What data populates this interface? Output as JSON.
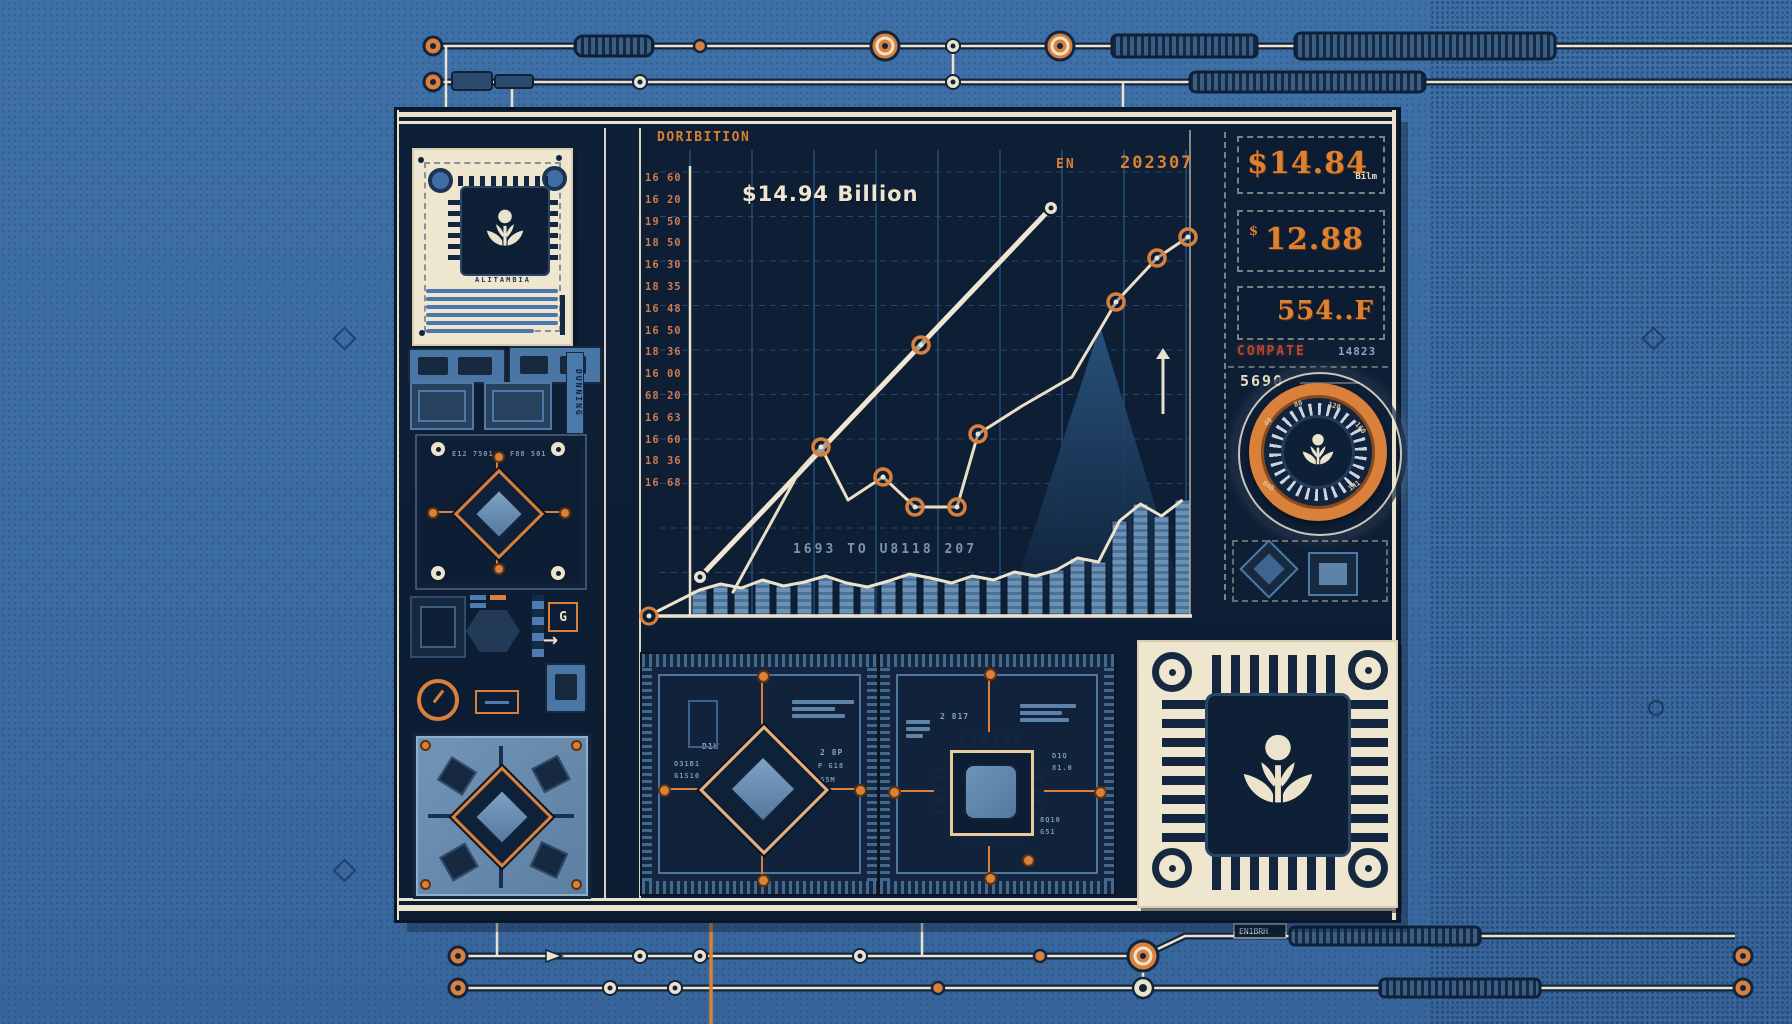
{
  "chart": {
    "title": "DORIBITION",
    "annotation": "$14.94 Billion",
    "legend_label": "EN",
    "period": "202307",
    "xlabel": "1693 TO U8118 207"
  },
  "chart_data": {
    "type": "line",
    "title": "DORIBITION",
    "annotation": "$14.94 Billion",
    "legend": [
      "EN",
      "202307"
    ],
    "xlabel": "1693 TO U8118 207",
    "ylabel": "",
    "y_tick_labels": [
      "16 60",
      "16 20",
      "19 50",
      "18 50",
      "16 30",
      "18 35",
      "16 48",
      "16 50",
      "18 36",
      "16 00",
      "68 20",
      "16 63",
      "16 60",
      "18 36",
      "16 68"
    ],
    "plot_area": {
      "x0": 645,
      "y0": 130,
      "x1": 1192,
      "y1": 616
    },
    "grid": {
      "vx_start": 690,
      "vx_step": 62,
      "vx_count": 9,
      "hy_start": 172,
      "hy_step": 44.5,
      "hy_count": 11
    },
    "series": [
      {
        "name": "growth-primary",
        "color": "#f0e7d2",
        "width": 5,
        "points": [
          [
            700,
            577
          ],
          [
            1051,
            208
          ]
        ],
        "white_markers": [
          [
            700,
            577
          ],
          [
            1051,
            208
          ]
        ],
        "orange_markers": [
          [
            921,
            345
          ]
        ]
      },
      {
        "name": "growth-secondary",
        "color": "#e9dfc6",
        "width": 3,
        "points": [
          [
            733,
            592
          ],
          [
            800,
            470
          ],
          [
            821,
            447
          ],
          [
            848,
            500
          ],
          [
            883,
            477
          ],
          [
            915,
            507
          ],
          [
            957,
            507
          ],
          [
            978,
            434
          ],
          [
            1022,
            406
          ],
          [
            1072,
            377
          ],
          [
            1116,
            302
          ],
          [
            1157,
            258
          ],
          [
            1188,
            237
          ]
        ],
        "white_markers": [],
        "orange_markers": [
          [
            821,
            447
          ],
          [
            883,
            477
          ],
          [
            915,
            507
          ],
          [
            957,
            507
          ],
          [
            978,
            434
          ],
          [
            1116,
            302
          ],
          [
            1157,
            258
          ],
          [
            1188,
            237
          ]
        ]
      }
    ],
    "bars": {
      "baseline": 616,
      "x_start": 692,
      "bar_width": 15,
      "pitch": 21,
      "heights": [
        26,
        32,
        28,
        36,
        30,
        34,
        40,
        33,
        29,
        35,
        42,
        38,
        33,
        40,
        36,
        44,
        40,
        46,
        58,
        54,
        95,
        112,
        100,
        116
      ]
    },
    "mountain": [
      [
        1006,
        616
      ],
      [
        1100,
        326
      ],
      [
        1189,
        616
      ]
    ],
    "arrow_up": {
      "x": 1163,
      "y_top": 348,
      "y_bottom": 414
    }
  },
  "stats": {
    "stat1": {
      "value": "$14.84",
      "unit": "Bilm"
    },
    "stat2": {
      "currency": "$",
      "value": "12.88"
    },
    "stat3": {
      "value": "554..F"
    },
    "compare_label": "COMPATE",
    "compare_code": "14823",
    "reading": "5690",
    "gauge_ticks": [
      "40",
      "80",
      "120",
      "160",
      "1N1",
      "04D"
    ]
  },
  "left": {
    "card_chip_label": "ALITAMBIA",
    "strip_label": "DUNNING",
    "module_label_left": "E12 7501",
    "module_label_right": "F88 501",
    "glyph_box": "G",
    "arrow_glyph": "→"
  },
  "bottom": {
    "a_labels": {
      "l1": "D1W",
      "l2": "O31B1",
      "l3": "G1S10",
      "r1": "2 8P",
      "r2": "P G18",
      "r3": "G5M"
    },
    "b_labels": {
      "t1": "2 817",
      "r1": "D1Q",
      "r2": "81.0",
      "b1": "8Q10",
      "b2": "G51"
    }
  },
  "rails": {
    "tag": "EN1BRH"
  }
}
